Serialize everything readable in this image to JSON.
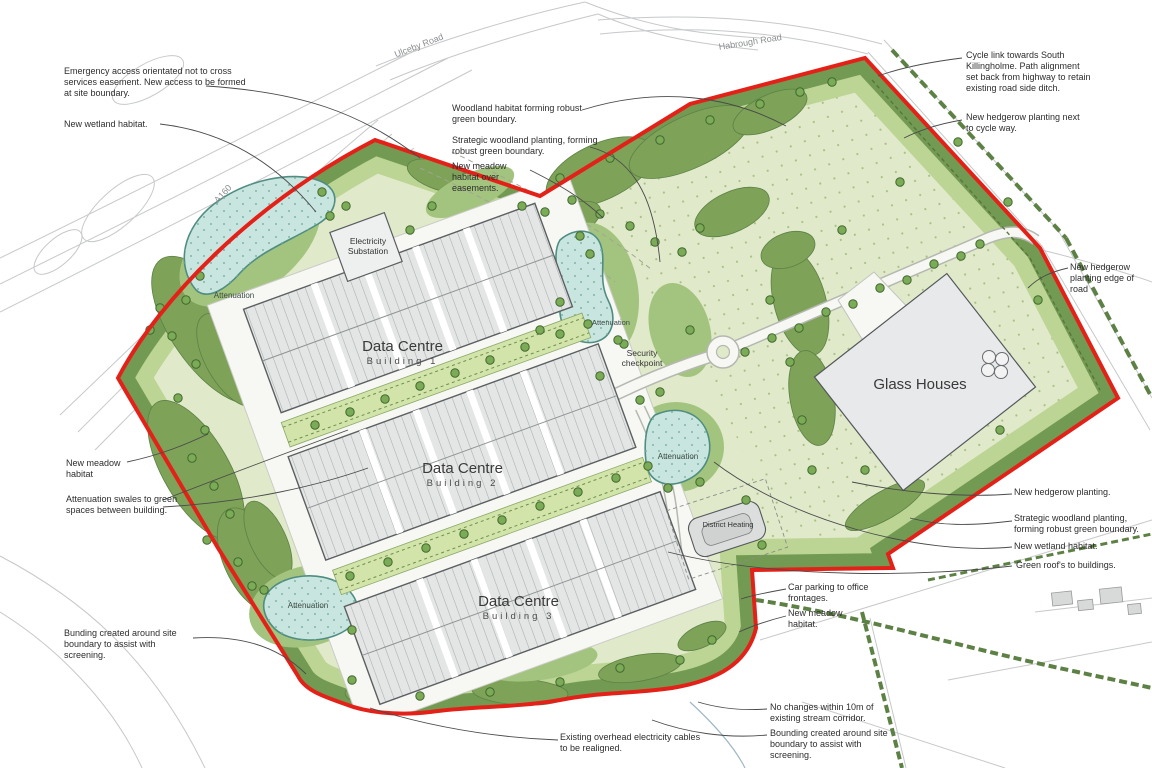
{
  "plan": {
    "roads": {
      "ulceby": "Ulceby Road",
      "habrough": "Habrough Road",
      "a160": "A160"
    },
    "buildings": {
      "dc1_title": "Data Centre",
      "dc1_sub": "Building 1",
      "dc2_title": "Data Centre",
      "dc2_sub": "Building 2",
      "dc3_title": "Data Centre",
      "dc3_sub": "Building 3",
      "glass_houses": "Glass Houses",
      "substation_line1": "Electricity",
      "substation_line2": "Substation",
      "district_heating": "District Heating",
      "security_line1": "Security",
      "security_line2": "checkpoint"
    },
    "ponds": {
      "label1": "Attenuation",
      "label2": "Attenuation",
      "label3": "Attenuation",
      "label4": "Attenuation"
    },
    "annotations": {
      "emergency_access": "Emergency access orientated not to cross services easement.  New access to be formed at site boundary.",
      "wetland_left": "New wetland habitat.",
      "woodland_habitat": "Woodland habitat forming robust green boundary.",
      "strategic_woodland_top": "Strategic woodland planting, forming robust green boundary.",
      "meadow_easements": "New meadow habitat over easements.",
      "cycle_link": "Cycle link towards South Killingholme.  Path alignment set back from highway to retain existing road side ditch.",
      "hedgerow_cycle": "New hedgerow planting next to cycle way.",
      "hedgerow_road_edge": "New hedgerow planting edge of road",
      "hedgerow_right": "New hedgerow planting.",
      "strategic_woodland_right": "Strategic woodland planting, forming robust green boundary.",
      "wetland_right": "New wetland habitat.",
      "green_roofs": "Green roof's to buildings.",
      "meadow_left": "New meadow habitat",
      "attenuation_swales": "Attenuation swales to green spaces between building.",
      "bunding_left": "Bunding created around site boundary to assist with screening.",
      "overhead_cables": "Existing overhead electricity cables to be realigned.",
      "car_parking": "Car parking to office frontages.",
      "meadow_bottom": "New meadow habitat.",
      "stream_corridor": "No changes within 10m of existing stream corridor.",
      "bounding_bottom": "Bounding created around site boundary to assist with screening."
    },
    "colors": {
      "boundary_red": "#e32119",
      "meadow_light": "#e0eaca",
      "woodland_dark": "#739a52",
      "green_mid": "#a3c47e",
      "pond_fill": "#c9e5df",
      "pond_edge": "#4f8d82",
      "building_grey": "#e4e6e6"
    }
  }
}
